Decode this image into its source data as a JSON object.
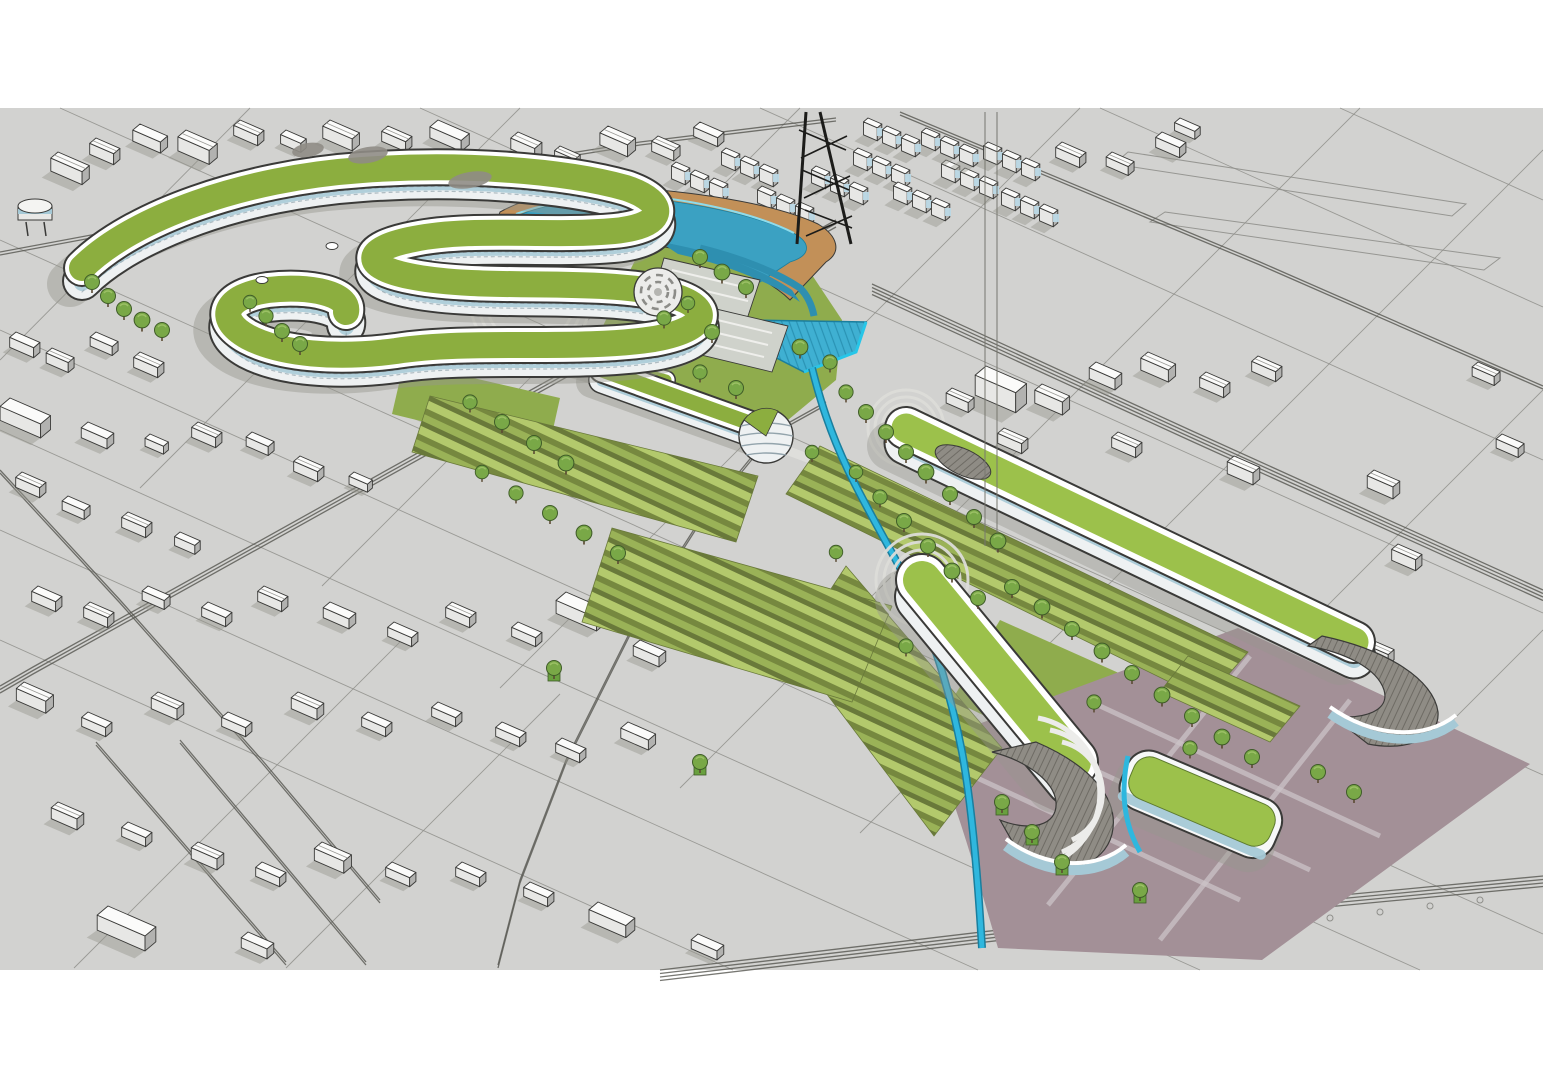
{
  "meta": {
    "kind": "3d-architectural-massing-render",
    "subject": "green-roof masterplan with serpentine building, lagoon pool, canal, oval roof slabs and context city"
  },
  "palette": {
    "pageBg": "#ffffff",
    "ground": "#d2d2d0",
    "roadLine": "#55554f",
    "parcelLine": "#8f8f8b",
    "topFace": "#fbfbfa",
    "faceLight": "#e7e7e5",
    "faceShade": "#b2b2b0",
    "outline": "#3a3a38",
    "shadow": "#96968f",
    "roofGreen": "#8cae3f",
    "roofGreenBright": "#9cc14b",
    "lawnFlat": "#8fac4d",
    "lawnLight": "#b3c96c",
    "lawnMid": "#9ab257",
    "lawnDark": "#76883f",
    "lawnDeep": "#69793a",
    "tree": "#79a847",
    "treeDark": "#3f5c28",
    "treeLight": "#a4c66d",
    "trunk": "#5b4a33",
    "facade": "#eef1f2",
    "facadeDash": "#93a4ac",
    "glass": "#a5c9d6",
    "glassCube": "#bcd9e6",
    "poolWater": "#3ba1c2",
    "poolDeep": "#2e8fb0",
    "poolRim": "#8edcec",
    "canal": "#2fb7de",
    "canalDark": "#1a7e9d",
    "pond": "#3fb0d2",
    "pondLine": "#2a93b4",
    "pondRim": "#27c6e8",
    "sand": "#c29058",
    "orange": "#f09a2e",
    "mauve": "#a39097",
    "mauveLight": "#cbc3c7",
    "deck": "#8f8c85",
    "deckLine": "#6e6b64",
    "lot": "#cfd2cb",
    "black": "#1c1c1a"
  },
  "scene": {
    "ground": {
      "x": 0,
      "y": 108,
      "w": 1543,
      "h": 862
    },
    "parcel_lines": [
      [
        0,
        240,
        1543,
        934
      ],
      [
        0,
        330,
        1420,
        970
      ],
      [
        0,
        430,
        1200,
        970
      ],
      [
        0,
        530,
        978,
        970
      ],
      [
        0,
        640,
        733,
        970
      ],
      [
        60,
        108,
        1543,
        775
      ],
      [
        420,
        108,
        1543,
        613
      ],
      [
        760,
        108,
        1543,
        460
      ],
      [
        1100,
        108,
        1543,
        307
      ],
      [
        1340,
        108,
        1543,
        200
      ],
      [
        250,
        108,
        0,
        360
      ],
      [
        520,
        108,
        140,
        488
      ],
      [
        800,
        108,
        322,
        586
      ],
      [
        1080,
        108,
        500,
        688
      ],
      [
        1360,
        108,
        680,
        788
      ],
      [
        1543,
        150,
        860,
        833
      ],
      [
        1543,
        390,
        1020,
        913
      ],
      [
        1543,
        630,
        1216,
        957
      ],
      [
        410,
        632,
        74,
        968
      ],
      [
        560,
        694,
        286,
        968
      ]
    ],
    "road_loops": [
      [
        1128,
        152,
        1466,
        204,
        1452,
        216,
        1114,
        164
      ],
      [
        1165,
        212,
        1500,
        258,
        1484,
        270,
        1150,
        222
      ]
    ],
    "road_corridors": [
      {
        "pts": [
          [
            836,
            220
          ],
          [
            513,
            400
          ],
          [
            33,
            667
          ],
          [
            0,
            686
          ]
        ],
        "lanes": 3,
        "gap": 3.5
      },
      {
        "pts": [
          [
            872,
            284
          ],
          [
            1190,
            430
          ],
          [
            1543,
            590
          ]
        ],
        "lanes": 4,
        "gap": 3.5
      },
      {
        "pts": [
          [
            0,
            252
          ],
          [
            300,
            196
          ],
          [
            640,
            142
          ],
          [
            836,
            118
          ]
        ],
        "lanes": 2,
        "gap": 3
      },
      {
        "pts": [
          [
            900,
            112
          ],
          [
            1260,
            262
          ],
          [
            1543,
            386
          ]
        ],
        "lanes": 2,
        "gap": 3
      },
      {
        "pts": [
          [
            660,
            970
          ],
          [
            1100,
            918
          ],
          [
            1543,
            876
          ]
        ],
        "lanes": 4,
        "gap": 3.5
      },
      {
        "pts": [
          [
            96,
            742
          ],
          [
            286,
            962
          ]
        ],
        "lanes": 2,
        "gap": 3
      },
      {
        "pts": [
          [
            180,
            740
          ],
          [
            366,
            962
          ]
        ],
        "lanes": 2,
        "gap": 3
      },
      {
        "pts": [
          [
            0,
            470
          ],
          [
            120,
            600
          ],
          [
            262,
            760
          ],
          [
            380,
            900
          ]
        ],
        "lanes": 2,
        "gap": 3
      },
      {
        "pts": [
          [
            826,
            402
          ],
          [
            772,
            432
          ],
          [
            700,
            520
          ],
          [
            636,
            620
          ],
          [
            566,
            760
          ],
          [
            520,
            880
          ],
          [
            498,
            965
          ]
        ],
        "lanes": 2,
        "gap": 3
      }
    ],
    "tree_pit_dots": [
      [
        1130,
        942
      ],
      [
        1180,
        936
      ],
      [
        1230,
        930
      ],
      [
        1280,
        924
      ],
      [
        1330,
        918
      ],
      [
        1380,
        912
      ],
      [
        1430,
        906
      ],
      [
        1480,
        900
      ]
    ],
    "context_buildings": [
      [
        58,
        152,
        34,
        16,
        13,
        "g"
      ],
      [
        96,
        138,
        26,
        14,
        11,
        "g"
      ],
      [
        140,
        124,
        30,
        16,
        11,
        "f"
      ],
      [
        186,
        130,
        34,
        18,
        14,
        "g"
      ],
      [
        240,
        120,
        26,
        14,
        10,
        "g"
      ],
      [
        286,
        130,
        22,
        12,
        9,
        "f"
      ],
      [
        330,
        120,
        32,
        16,
        12,
        "g"
      ],
      [
        388,
        126,
        26,
        14,
        10,
        "g"
      ],
      [
        438,
        120,
        34,
        18,
        11,
        "f"
      ],
      [
        302,
        158,
        26,
        16,
        10,
        "g"
      ],
      [
        356,
        152,
        22,
        12,
        9,
        "g"
      ],
      [
        420,
        158,
        26,
        14,
        10,
        "g"
      ],
      [
        470,
        152,
        22,
        12,
        9,
        "f"
      ],
      [
        518,
        132,
        26,
        16,
        11,
        "g"
      ],
      [
        560,
        146,
        22,
        12,
        9,
        "g"
      ],
      [
        608,
        126,
        30,
        18,
        12,
        "g"
      ],
      [
        658,
        136,
        24,
        14,
        10,
        "g"
      ],
      [
        700,
        122,
        26,
        14,
        9,
        "f"
      ],
      [
        622,
        182,
        0,
        0,
        0,
        "c"
      ],
      [
        676,
        162,
        0,
        0,
        0,
        "c"
      ],
      [
        726,
        148,
        0,
        0,
        0,
        "c"
      ],
      [
        762,
        186,
        0,
        0,
        0,
        "c"
      ],
      [
        816,
        166,
        0,
        0,
        0,
        "c"
      ],
      [
        858,
        148,
        0,
        0,
        0,
        "c"
      ],
      [
        898,
        182,
        0,
        0,
        0,
        "c"
      ],
      [
        946,
        160,
        0,
        0,
        0,
        "c"
      ],
      [
        988,
        142,
        0,
        0,
        0,
        "c"
      ],
      [
        926,
        128,
        0,
        0,
        0,
        "c"
      ],
      [
        868,
        118,
        0,
        0,
        0,
        "c"
      ],
      [
        1006,
        188,
        0,
        0,
        0,
        "c"
      ],
      [
        1062,
        142,
        26,
        14,
        10,
        "g"
      ],
      [
        1112,
        152,
        24,
        13,
        9,
        "g"
      ],
      [
        1162,
        132,
        26,
        14,
        10,
        "f"
      ],
      [
        1180,
        118,
        22,
        12,
        8,
        "f"
      ],
      [
        986,
        366,
        44,
        24,
        20,
        "f"
      ],
      [
        1042,
        384,
        30,
        16,
        13,
        "g"
      ],
      [
        1096,
        362,
        28,
        15,
        11,
        "f"
      ],
      [
        1148,
        352,
        30,
        16,
        12,
        "g"
      ],
      [
        1206,
        372,
        26,
        14,
        10,
        "g"
      ],
      [
        1258,
        356,
        26,
        14,
        10,
        "g"
      ],
      [
        952,
        388,
        24,
        13,
        10,
        "g"
      ],
      [
        1004,
        428,
        26,
        14,
        10,
        "g"
      ],
      [
        1118,
        432,
        26,
        14,
        10,
        "g"
      ],
      [
        1234,
        456,
        28,
        15,
        12,
        "g"
      ],
      [
        1374,
        470,
        28,
        15,
        12,
        "g"
      ],
      [
        1398,
        544,
        26,
        14,
        11,
        "g"
      ],
      [
        1372,
        640,
        24,
        13,
        10,
        "g"
      ],
      [
        1478,
        362,
        24,
        13,
        9,
        "g"
      ],
      [
        1502,
        434,
        24,
        13,
        9,
        "f"
      ],
      [
        16,
        332,
        26,
        14,
        10,
        "f"
      ],
      [
        52,
        348,
        24,
        13,
        10,
        "g"
      ],
      [
        96,
        332,
        24,
        13,
        9,
        "f"
      ],
      [
        140,
        352,
        26,
        14,
        10,
        "g"
      ],
      [
        10,
        398,
        44,
        22,
        14,
        "f"
      ],
      [
        88,
        422,
        28,
        15,
        10,
        "f"
      ],
      [
        150,
        434,
        20,
        11,
        8,
        "f"
      ],
      [
        198,
        422,
        26,
        14,
        10,
        "g"
      ],
      [
        252,
        432,
        24,
        13,
        9,
        "f"
      ],
      [
        300,
        456,
        26,
        14,
        10,
        "g"
      ],
      [
        354,
        472,
        20,
        11,
        8,
        "f"
      ],
      [
        22,
        472,
        26,
        14,
        10,
        "g"
      ],
      [
        68,
        496,
        24,
        13,
        9,
        "f"
      ],
      [
        128,
        512,
        26,
        14,
        10,
        "g"
      ],
      [
        180,
        532,
        22,
        12,
        9,
        "f"
      ],
      [
        428,
        392,
        48,
        20,
        12,
        "f"
      ],
      [
        38,
        586,
        26,
        14,
        10,
        "f"
      ],
      [
        90,
        602,
        26,
        14,
        10,
        "g"
      ],
      [
        148,
        586,
        24,
        13,
        9,
        "f"
      ],
      [
        208,
        602,
        26,
        14,
        9,
        "f"
      ],
      [
        264,
        586,
        26,
        14,
        10,
        "g"
      ],
      [
        330,
        602,
        28,
        15,
        10,
        "f"
      ],
      [
        394,
        622,
        26,
        14,
        9,
        "f"
      ],
      [
        452,
        602,
        26,
        14,
        10,
        "g"
      ],
      [
        518,
        622,
        26,
        14,
        9,
        "f"
      ],
      [
        566,
        592,
        44,
        22,
        13,
        "f"
      ],
      [
        640,
        640,
        28,
        15,
        10,
        "f"
      ],
      [
        700,
        620,
        26,
        14,
        9,
        "f"
      ],
      [
        24,
        682,
        32,
        17,
        12,
        "g"
      ],
      [
        88,
        712,
        26,
        14,
        9,
        "f"
      ],
      [
        158,
        692,
        28,
        15,
        11,
        "g"
      ],
      [
        228,
        712,
        26,
        14,
        9,
        "f"
      ],
      [
        298,
        692,
        28,
        15,
        11,
        "g"
      ],
      [
        368,
        712,
        26,
        14,
        9,
        "f"
      ],
      [
        438,
        702,
        26,
        14,
        9,
        "f"
      ],
      [
        502,
        722,
        26,
        14,
        9,
        "f"
      ],
      [
        562,
        738,
        26,
        14,
        9,
        "f"
      ],
      [
        628,
        722,
        30,
        16,
        10,
        "f"
      ],
      [
        58,
        802,
        28,
        15,
        11,
        "g"
      ],
      [
        128,
        822,
        26,
        14,
        9,
        "f"
      ],
      [
        198,
        842,
        28,
        15,
        11,
        "g"
      ],
      [
        262,
        862,
        26,
        14,
        9,
        "f"
      ],
      [
        322,
        842,
        32,
        17,
        12,
        "g"
      ],
      [
        392,
        862,
        26,
        14,
        9,
        "f"
      ],
      [
        108,
        906,
        52,
        24,
        15,
        "f"
      ],
      [
        248,
        932,
        28,
        15,
        10,
        "f"
      ],
      [
        462,
        862,
        26,
        14,
        9,
        "f"
      ],
      [
        530,
        882,
        26,
        14,
        9,
        "f"
      ],
      [
        598,
        902,
        40,
        20,
        12,
        "f"
      ],
      [
        698,
        934,
        28,
        15,
        9,
        "f"
      ]
    ],
    "trees": [
      [
        92,
        282,
        1
      ],
      [
        108,
        296,
        1
      ],
      [
        124,
        309,
        1
      ],
      [
        142,
        320,
        1.05
      ],
      [
        162,
        330,
        1
      ],
      [
        250,
        302,
        0.9
      ],
      [
        266,
        316,
        0.95
      ],
      [
        282,
        331,
        1
      ],
      [
        300,
        344,
        1
      ],
      [
        700,
        257,
        1
      ],
      [
        722,
        272,
        1.05
      ],
      [
        746,
        287,
        1
      ],
      [
        688,
        303,
        0.9
      ],
      [
        664,
        318,
        0.95
      ],
      [
        712,
        332,
        1
      ],
      [
        800,
        347,
        1.05
      ],
      [
        700,
        372,
        0.95
      ],
      [
        736,
        388,
        1
      ],
      [
        830,
        362,
        0.95
      ],
      [
        846,
        392,
        0.95
      ],
      [
        866,
        412,
        1
      ],
      [
        886,
        432,
        1
      ],
      [
        906,
        452,
        1
      ],
      [
        926,
        472,
        1.05
      ],
      [
        950,
        494,
        1
      ],
      [
        974,
        517,
        1
      ],
      [
        998,
        541,
        1.05
      ],
      [
        856,
        472,
        0.9
      ],
      [
        880,
        497,
        0.95
      ],
      [
        904,
        521,
        1
      ],
      [
        928,
        546,
        1
      ],
      [
        952,
        571,
        1.05
      ],
      [
        978,
        598,
        1
      ],
      [
        812,
        452,
        0.9
      ],
      [
        836,
        552,
        0.9
      ],
      [
        906,
        646,
        0.95
      ],
      [
        1012,
        587,
        1
      ],
      [
        1042,
        607,
        1.05
      ],
      [
        1072,
        629,
        1
      ],
      [
        1102,
        651,
        1.05
      ],
      [
        1132,
        673,
        1
      ],
      [
        1162,
        695,
        1.05
      ],
      [
        1192,
        716,
        1
      ],
      [
        1222,
        737,
        1.05
      ],
      [
        1252,
        757,
        1
      ],
      [
        470,
        402,
        0.95
      ],
      [
        502,
        422,
        1
      ],
      [
        534,
        443,
        1
      ],
      [
        566,
        463,
        1.05
      ],
      [
        482,
        472,
        0.9
      ],
      [
        516,
        493,
        0.95
      ],
      [
        550,
        513,
        1
      ],
      [
        584,
        533,
        1.05
      ],
      [
        618,
        553,
        1
      ],
      [
        1318,
        772,
        1
      ],
      [
        1354,
        792,
        1
      ],
      [
        1094,
        702,
        0.95
      ],
      [
        1190,
        748,
        0.95
      ]
    ],
    "planter_trees": [
      [
        1002,
        802
      ],
      [
        1032,
        832
      ],
      [
        1062,
        862
      ],
      [
        554,
        668
      ],
      [
        700,
        762
      ],
      [
        1140,
        890
      ]
    ]
  }
}
